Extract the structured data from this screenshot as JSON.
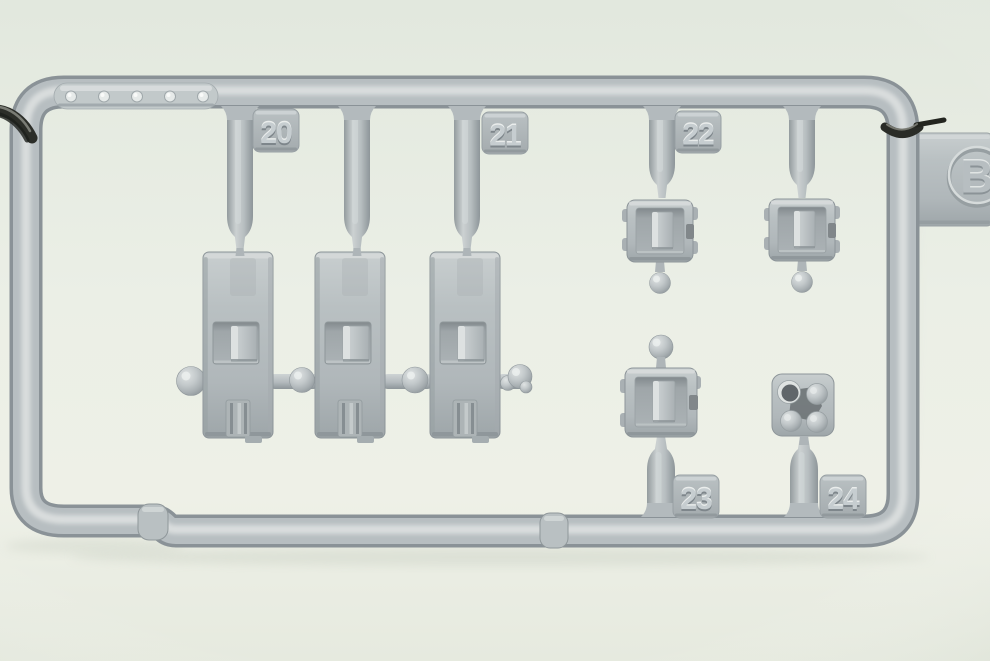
{
  "photo": {
    "subject": "Macro photograph of a light gray injection-molded model kit sprue (runner) holding numbered parts, clipped at both sides, on a pale green-white backdrop",
    "sprue_letter": "B",
    "alignment_dot_count": 5,
    "large_parts_count": 3,
    "small_hatch_parts_count": 3,
    "colors": {
      "background": "#ebefe6",
      "plastic_base": "#b7bec1",
      "plastic_highlight": "#d9dddd",
      "plastic_shadow": "#8a9297",
      "recess": "#a4abae",
      "metal_clip": "#2c2e29"
    }
  },
  "labels": {
    "tag20": "20",
    "tag21": "21",
    "tag22": "22",
    "tag23": "23",
    "tag24": "24",
    "letter": "B"
  }
}
